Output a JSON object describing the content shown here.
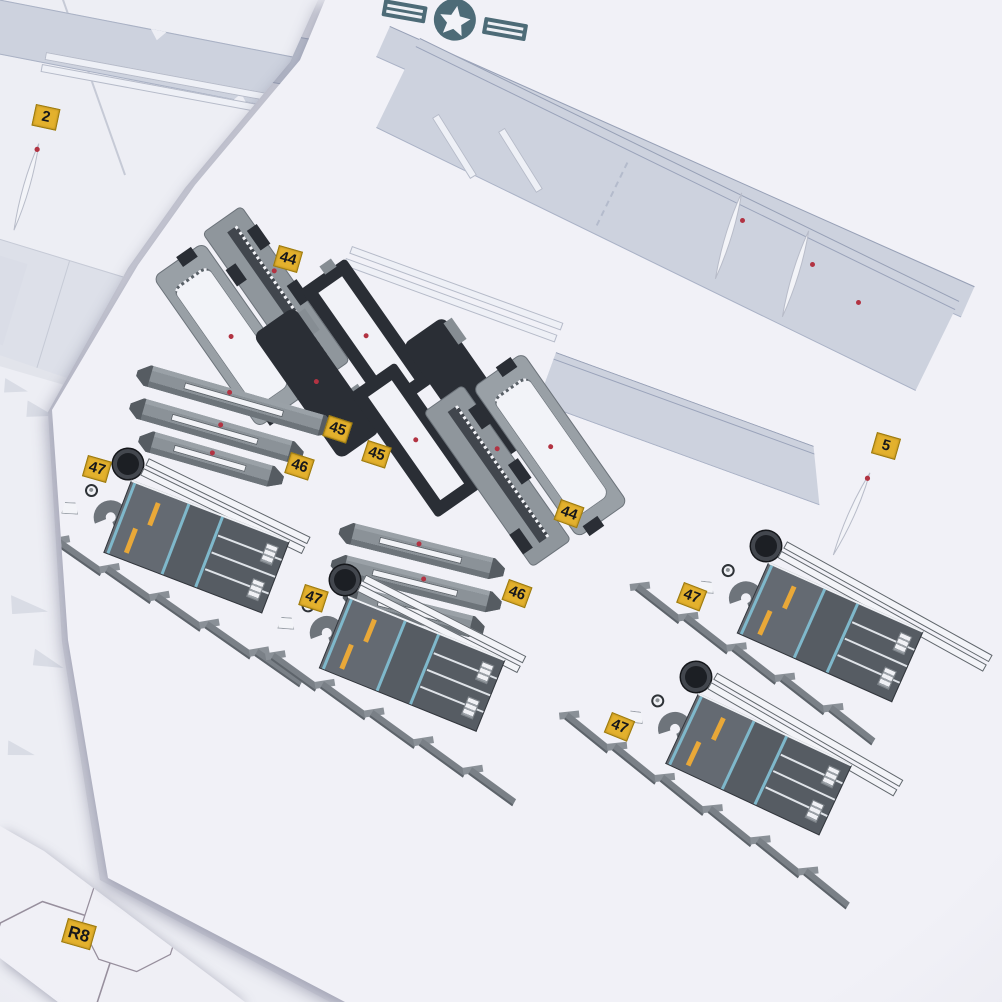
{
  "labels": {
    "tag_2": "2",
    "tag_5": "5",
    "tag_44_left": "44",
    "tag_44_mid": "44",
    "tag_45_a": "45",
    "tag_45_b": "45",
    "tag_46_left": "46",
    "tag_46_mid": "46",
    "tag_47_a": "47",
    "tag_47_b": "47",
    "tag_47_c": "47",
    "tag_47_d": "47",
    "tag_r8": "R8",
    "tag_r_partial": "R"
  },
  "icons": {
    "roundel": "us-star-roundel-icon"
  },
  "colors": {
    "paper_white": "#f1f1f7",
    "paper_under": "#e7e8ef",
    "background_shadow": "#c2c4d0",
    "print_light_band": "#cdd2de",
    "part_gray": "#8f969c",
    "part_dark": "#2a2e35",
    "deck_gray": "#565c63",
    "stripe_cyan": "#7fb8cb",
    "dash_yellow": "#e9a838",
    "tag_yellow": "#e3b12d",
    "registration_dot_red": "#b23342",
    "insignia_slate": "#4d6b77"
  }
}
